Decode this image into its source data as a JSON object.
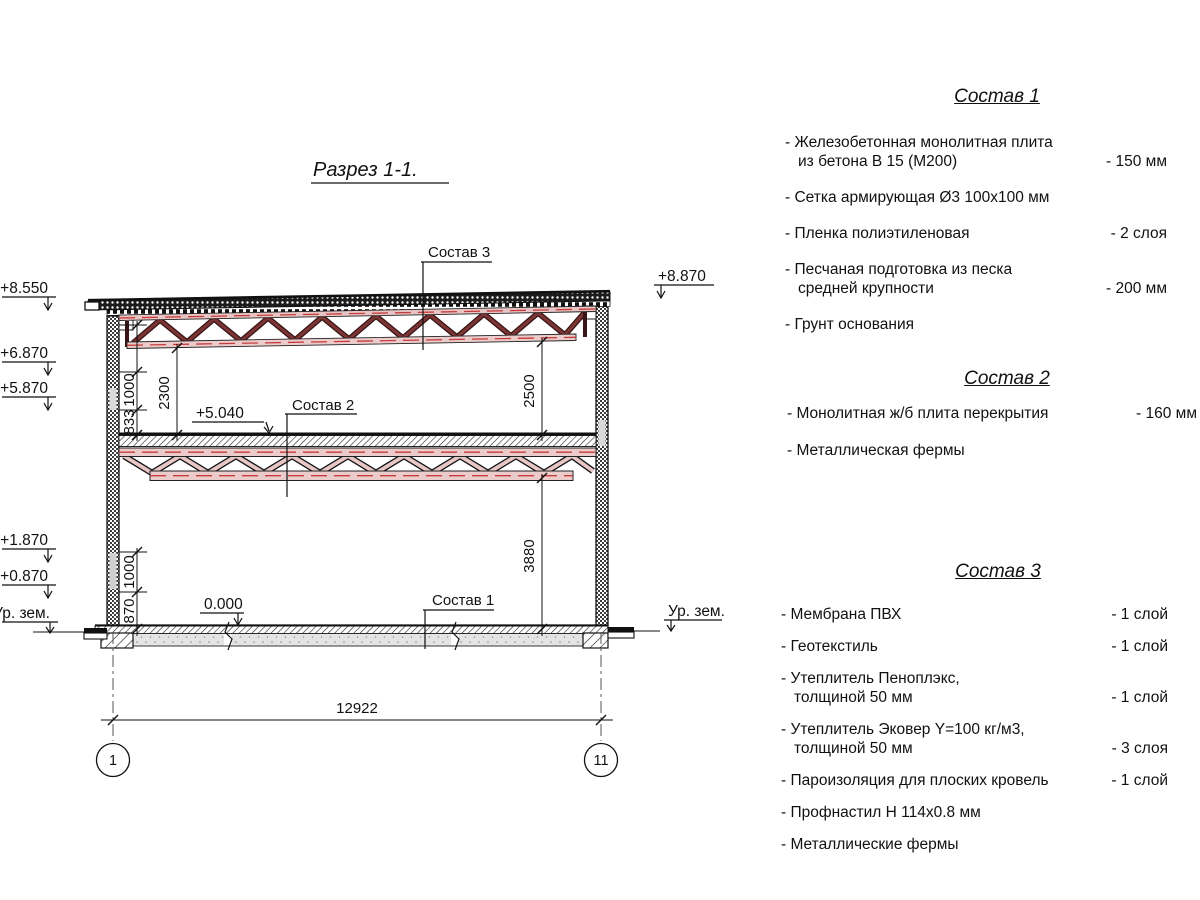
{
  "drawing": {
    "title": "Разрез 1-1.",
    "elevations": {
      "left_roof": "+8.550",
      "left_truss_support": "+6.870",
      "left_mid": "+5.870",
      "left_lower_a": "+1.870",
      "left_lower_b": "+0.870",
      "ground_left": "Ур. зем.",
      "right_roof": "+8.870",
      "ground_right": "Ур. зем.",
      "mid_slab": "+5.040",
      "floor_zero": "0.000"
    },
    "callouts": {
      "roof": "Состав 3",
      "mid_floor": "Состав 2",
      "ground_floor": "Состав 1"
    },
    "dimensions": {
      "upper_1000": "1000",
      "upper_833": "833",
      "upper_2300": "2300",
      "right_2500": "2500",
      "right_3880": "3880",
      "lower_1000": "1000",
      "lower_870": "870",
      "span": "12922"
    },
    "axes": {
      "left": "1",
      "right": "11"
    }
  },
  "specs": [
    {
      "title": "Состав 1",
      "items": [
        {
          "name": "- Железобетонная  монолитная плита\nиз бетона В 15 (М200)",
          "value": "- 150 мм"
        },
        {
          "name": "- Сетка армирующая Ø3 100х100 мм",
          "value": ""
        },
        {
          "name": "- Пленка полиэтиленовая",
          "value": "- 2 слоя"
        },
        {
          "name": "- Песчаная подготовка из песка\nсредней крупности",
          "value": "- 200 мм"
        },
        {
          "name": "- Грунт основания",
          "value": ""
        }
      ]
    },
    {
      "title": "Состав 2",
      "items": [
        {
          "name": "- Монолитная ж/б плита перекрытия",
          "value": "- 160 мм"
        },
        {
          "name": "- Металлическая фермы",
          "value": ""
        }
      ]
    },
    {
      "title": "Состав 3",
      "items": [
        {
          "name": "- Мембрана ПВХ",
          "value": "- 1 слой"
        },
        {
          "name": "- Геотекстиль",
          "value": "- 1 слой"
        },
        {
          "name": "- Утеплитель Пеноплэкс,\nтолщиной 50 мм",
          "value": "- 1 слой"
        },
        {
          "name": "- Утеплитель Эковер Y=100 кг/м3,\nтолщиной 50 мм",
          "value": "- 3 слоя"
        },
        {
          "name": "- Пароизоляция для плоских кровель",
          "value": "- 1 слой"
        },
        {
          "name": "- Профнастил Н 114х0.8 мм",
          "value": ""
        },
        {
          "name": "- Металлические фермы",
          "value": ""
        }
      ]
    }
  ],
  "colors": {
    "truss_dark": "#7c3535",
    "truss_light": "#e8c6c6",
    "centerline_red": "#c63c3c",
    "line": "#111111"
  }
}
